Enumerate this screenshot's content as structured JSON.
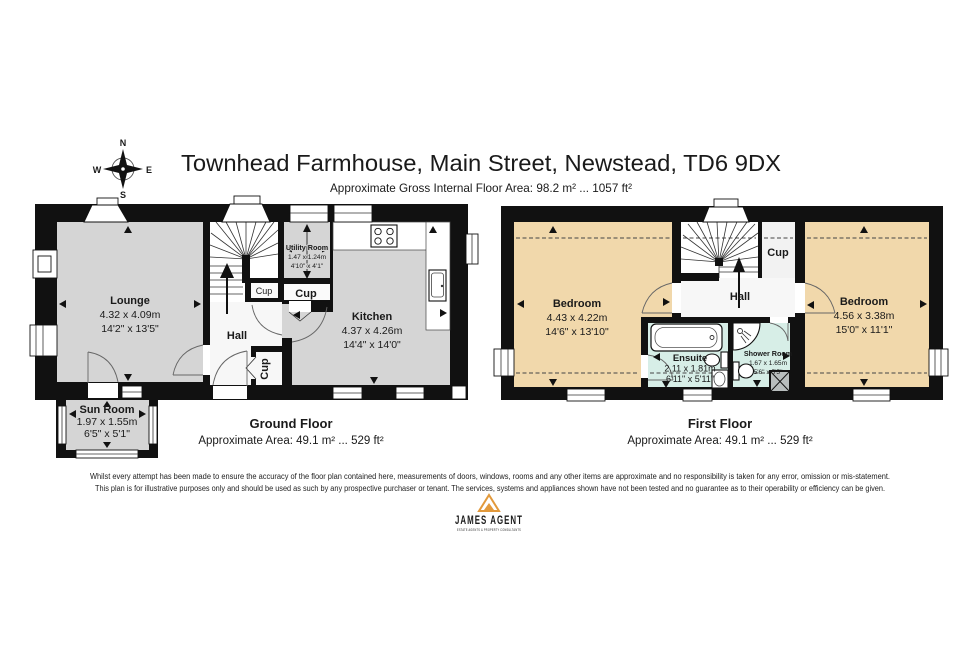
{
  "header": {
    "title": "Townhead Farmhouse, Main Street, Newstead, TD6 9DX",
    "subtitle": "Approximate Gross Internal Floor Area: 98.2 m² ... 1057 ft²"
  },
  "compass": {
    "north": "N",
    "east": "E",
    "south": "S",
    "west": "W"
  },
  "ground_floor": {
    "title": "Ground Floor",
    "area": "Approximate Area: 49.1 m² ... 529 ft²",
    "rooms": {
      "lounge": {
        "name": "Lounge",
        "metric": "4.32 x 4.09m",
        "imperial": "14'2\" x 13'5\""
      },
      "kitchen": {
        "name": "Kitchen",
        "metric": "4.37 x 4.26m",
        "imperial": "14'4\" x 14'0\""
      },
      "utility": {
        "name": "Utility Room",
        "metric": "1.47 x 1.24m",
        "imperial": "4'10\" x 4'1\""
      },
      "sun_room": {
        "name": "Sun Room",
        "metric": "1.97 x 1.55m",
        "imperial": "6'5\" x 5'1\""
      },
      "hall": {
        "name": "Hall"
      },
      "cupboard_under_stairs": {
        "name": "Cup"
      },
      "cupboard_main": {
        "name": "Cup"
      },
      "cupboard_hall": {
        "name": "Cup"
      }
    }
  },
  "first_floor": {
    "title": "First Floor",
    "area": "Approximate Area: 49.1 m² ... 529 ft²",
    "rooms": {
      "bedroom_left": {
        "name": "Bedroom",
        "metric": "4.43 x 4.22m",
        "imperial": "14'6\" x 13'10\""
      },
      "bedroom_right": {
        "name": "Bedroom",
        "metric": "4.56 x 3.38m",
        "imperial": "15'0\" x 11'1\""
      },
      "ensuite": {
        "name": "Ensuite",
        "metric": "2.11 x 1.81m",
        "imperial": "6'11\" x 5'11\""
      },
      "shower_room": {
        "name": "Shower Room",
        "metric": "1.67 x 1.65m",
        "imperial": "5'6\" x 5'5\""
      },
      "hall": {
        "name": "Hall"
      },
      "cupboard": {
        "name": "Cup"
      }
    }
  },
  "disclaimer": {
    "line1": "Whilst every attempt has been made to ensure the accuracy of the floor plan contained here, measurements of doors, windows, rooms and any other items are approximate and no responsibility is taken for any error, omission or mis-statement.",
    "line2": "This plan is for illustrative purposes only and should be used as such by any prospective purchaser or tenant. The services, systems and appliances shown have not been tested and no guarantee as to their operability or efficiency can be given."
  },
  "brand": {
    "name": "JAMES AGENT",
    "tagline": "ESTATE AGENTS & PROPERTY CONSULTANTS"
  },
  "colors": {
    "wall": "#111111",
    "room_gray": "#d5d5d5",
    "bedroom_tan": "#f1d8ab",
    "bath_mint": "#d7eee7",
    "hall_white": "#f7f7f7",
    "accent_orange": "#e2993b",
    "brand_navy": "#2c3b4d"
  }
}
